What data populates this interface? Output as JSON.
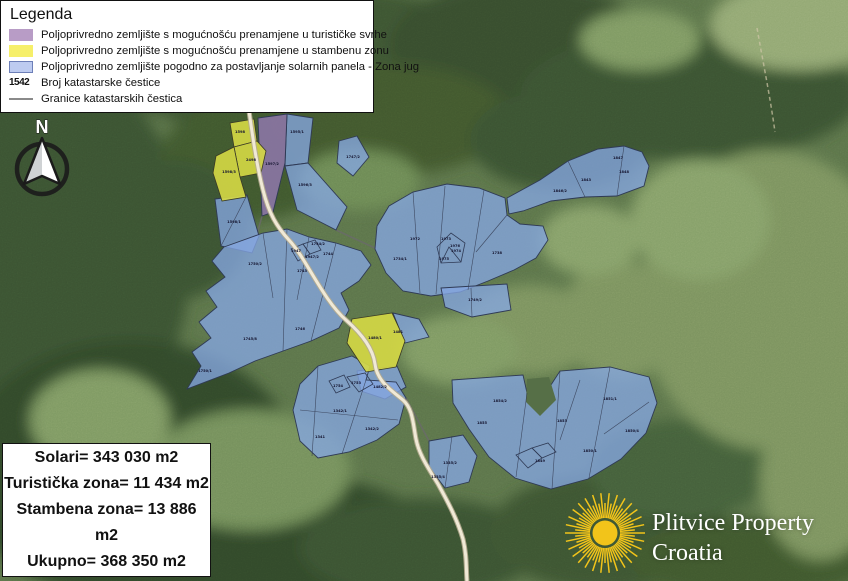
{
  "legend": {
    "title": "Legenda",
    "items": [
      {
        "key": "tourist",
        "color": "#b89cc6",
        "label": "Poljoprivredno zemljište s mogućnošću prenamjene u turističke svrhe"
      },
      {
        "key": "residential",
        "color": "#f6ef6a",
        "label": "Poljoprivredno zemljište s mogućnošću prenamjene u stambenu zonu"
      },
      {
        "key": "solar",
        "color": "#bdcbf0",
        "label": "Poljoprivredno zemljište pogodno za postavljanje solarnih panela - Zona jug"
      },
      {
        "key": "parcel-number",
        "text": "1542",
        "label": "Broj katastarske čestice"
      },
      {
        "key": "boundaries",
        "color": "#8a8a8a",
        "label": "Granice katastarskih čestica"
      }
    ]
  },
  "north_arrow": {
    "label": "N"
  },
  "stats": {
    "lines": [
      "Solari= 343 030 m2",
      "Turistička zona= 11 434 m2",
      "Stambena zona= 13 886 m2",
      "Ukupno= 368 350 m2"
    ]
  },
  "logo": {
    "line1": "Plitvice Property",
    "line2": "Croatia",
    "sun_color": "#f2c41a"
  },
  "map": {
    "colors": {
      "solar_fill": "#85a7e2",
      "tourist_fill": "#9579b5",
      "residential_fill": "#d6d945",
      "road": "#f0e9d6",
      "forest_base": "#5c744a"
    },
    "parcel_labels": [
      {
        "x": 240,
        "y": 133,
        "t": "1598"
      },
      {
        "x": 251,
        "y": 161,
        "t": "2498"
      },
      {
        "x": 229,
        "y": 173,
        "t": "1598/3"
      },
      {
        "x": 234,
        "y": 223,
        "t": "1598/1"
      },
      {
        "x": 297,
        "y": 133,
        "t": "1595/1"
      },
      {
        "x": 305,
        "y": 186,
        "t": "1596/3"
      },
      {
        "x": 353,
        "y": 158,
        "t": "1747/2"
      },
      {
        "x": 272,
        "y": 165,
        "t": "1597/2"
      },
      {
        "x": 586,
        "y": 181,
        "t": "1843"
      },
      {
        "x": 624,
        "y": 173,
        "t": "1848"
      },
      {
        "x": 560,
        "y": 192,
        "t": "1846/2"
      },
      {
        "x": 618,
        "y": 159,
        "t": "1847"
      },
      {
        "x": 497,
        "y": 254,
        "t": "1738"
      },
      {
        "x": 446,
        "y": 240,
        "t": "1973"
      },
      {
        "x": 456,
        "y": 252,
        "t": "1974"
      },
      {
        "x": 444,
        "y": 260,
        "t": "1975"
      },
      {
        "x": 415,
        "y": 240,
        "t": "1972"
      },
      {
        "x": 400,
        "y": 260,
        "t": "1734/1"
      },
      {
        "x": 475,
        "y": 301,
        "t": "1749/2"
      },
      {
        "x": 255,
        "y": 265,
        "t": "1750/2"
      },
      {
        "x": 302,
        "y": 272,
        "t": "1743"
      },
      {
        "x": 328,
        "y": 255,
        "t": "1744"
      },
      {
        "x": 250,
        "y": 340,
        "t": "1745/8"
      },
      {
        "x": 300,
        "y": 330,
        "t": "1746"
      },
      {
        "x": 205,
        "y": 372,
        "t": "1750/1"
      },
      {
        "x": 318,
        "y": 245,
        "t": "1744/2"
      },
      {
        "x": 375,
        "y": 339,
        "t": "1480/1"
      },
      {
        "x": 398,
        "y": 333,
        "t": "1481"
      },
      {
        "x": 380,
        "y": 388,
        "t": "1482/2"
      },
      {
        "x": 340,
        "y": 412,
        "t": "1342/1"
      },
      {
        "x": 320,
        "y": 438,
        "t": "1341"
      },
      {
        "x": 372,
        "y": 430,
        "t": "1342/2"
      },
      {
        "x": 450,
        "y": 464,
        "t": "1335/2"
      },
      {
        "x": 438,
        "y": 478,
        "t": "1335/4"
      },
      {
        "x": 500,
        "y": 402,
        "t": "1854/2"
      },
      {
        "x": 562,
        "y": 422,
        "t": "1853"
      },
      {
        "x": 610,
        "y": 400,
        "t": "1851/1"
      },
      {
        "x": 632,
        "y": 432,
        "t": "1850/4"
      },
      {
        "x": 540,
        "y": 462,
        "t": "1849"
      },
      {
        "x": 482,
        "y": 424,
        "t": "1855"
      },
      {
        "x": 590,
        "y": 452,
        "t": "1850/1"
      },
      {
        "x": 296,
        "y": 252,
        "t": "1947"
      },
      {
        "x": 312,
        "y": 258,
        "t": "1947/2"
      },
      {
        "x": 356,
        "y": 384,
        "t": "1753"
      },
      {
        "x": 338,
        "y": 387,
        "t": "1754"
      },
      {
        "x": 455,
        "y": 247,
        "t": "1976"
      }
    ]
  }
}
